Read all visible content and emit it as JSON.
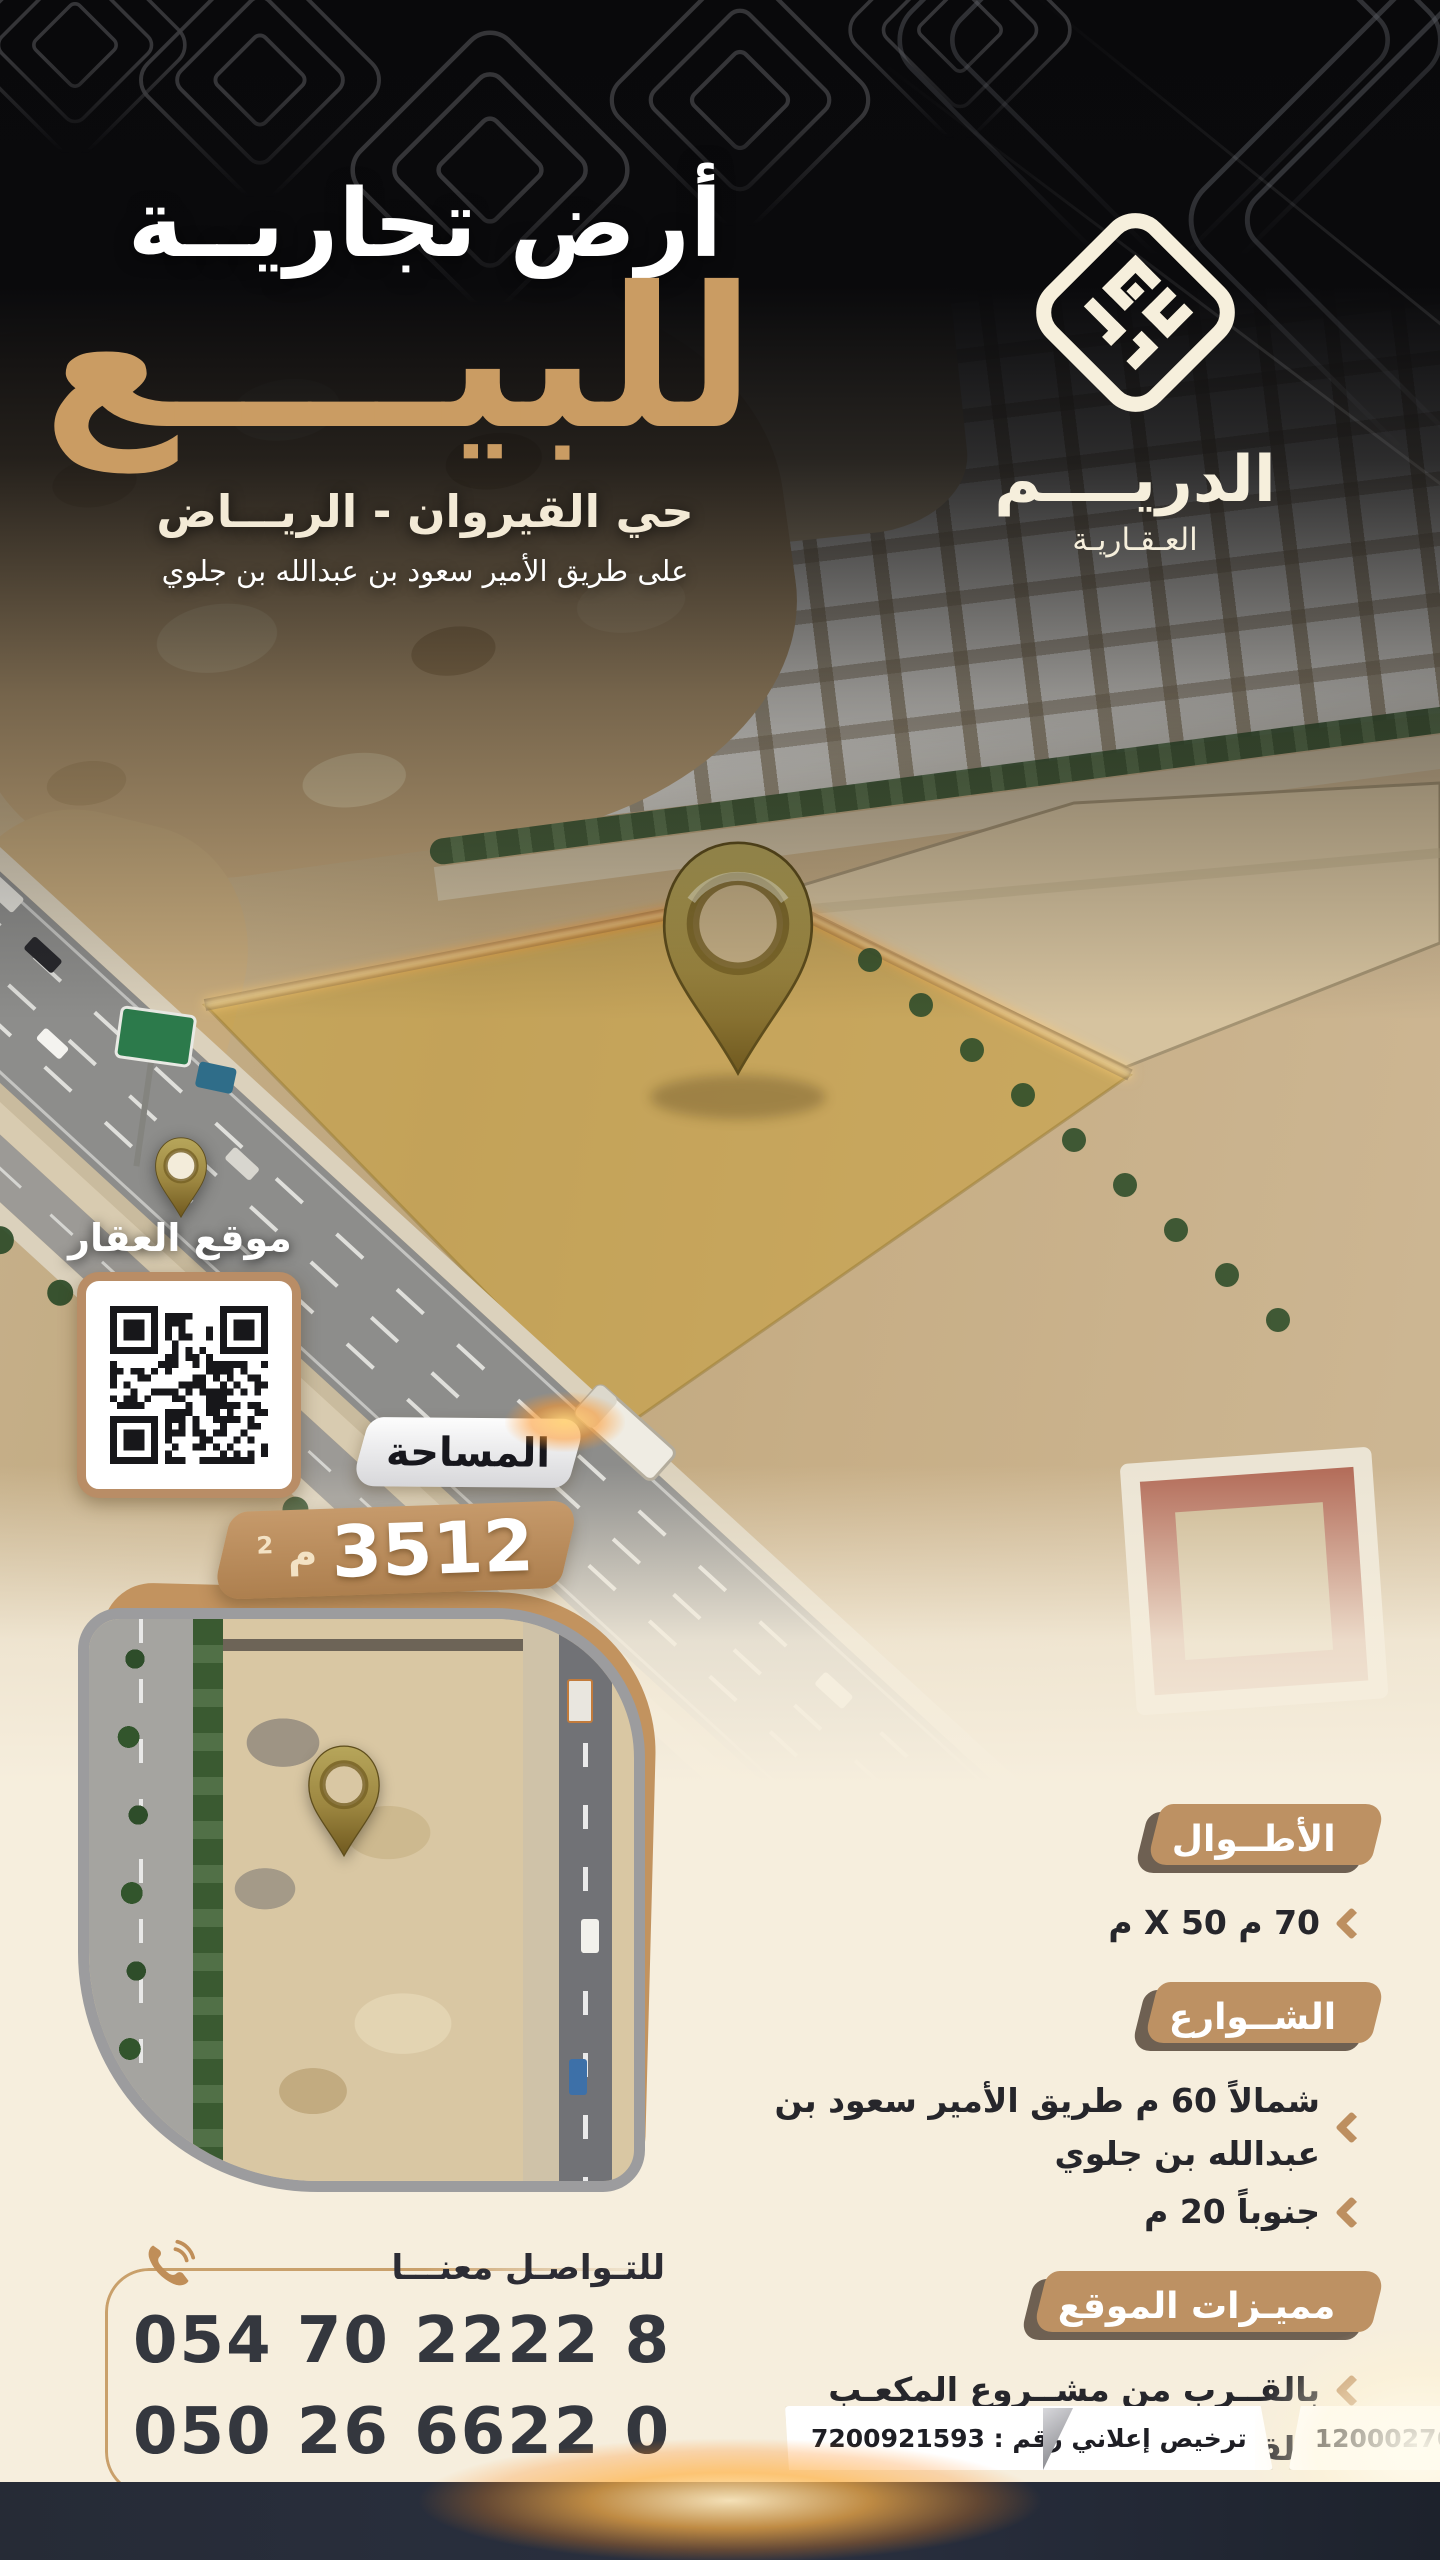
{
  "header": {
    "title": "أرض تجاريــة",
    "for_sale": "للبيــــع",
    "district": "حي القيروان - الريـــاض",
    "road": "على طريق الأمير سعود بن عبدالله بن جلوي"
  },
  "brand": {
    "name": "الدريــــم",
    "tagline": "العـقـاريـة"
  },
  "map": {
    "pin_label": "موقع العقار"
  },
  "area": {
    "label": "المساحة",
    "value": "3512",
    "unit": "م",
    "unit_sup": "2"
  },
  "sections": [
    {
      "title": "الأطــوال",
      "items": [
        "70 م X  50 م"
      ]
    },
    {
      "title": "الشــوارع",
      "items": [
        "شمالاً 60 م طريق الأمير سعود بن عبدالله بن جلوي",
        "جنوباً 20 م"
      ]
    },
    {
      "title": "مميـزات الموقع",
      "items": [
        "بالقــرب من مشــروع المكعـب",
        "بالقرب من طريق الملك سلمان",
        "بالقــرب من طريـق الملك خالد"
      ]
    }
  ],
  "contact": {
    "label": "للتـواصـل معنـــا",
    "phones": [
      "054 70 2222 8",
      "050 26 6622 0"
    ]
  },
  "licenses": [
    {
      "text": "رخصة عقارية رقم : 1200027687"
    },
    {
      "text": "ترخيص إعلاني رقم : 7200921593"
    }
  ],
  "colors": {
    "accent_tan": "#c49a6c",
    "badge_brown": "#6e6052",
    "cream": "#f6eedd",
    "navy_strip": "#262b36",
    "sale_tan": "#ca9c63",
    "glow_orange": "#ff9a2e",
    "gold_pin": "#9a8138"
  }
}
